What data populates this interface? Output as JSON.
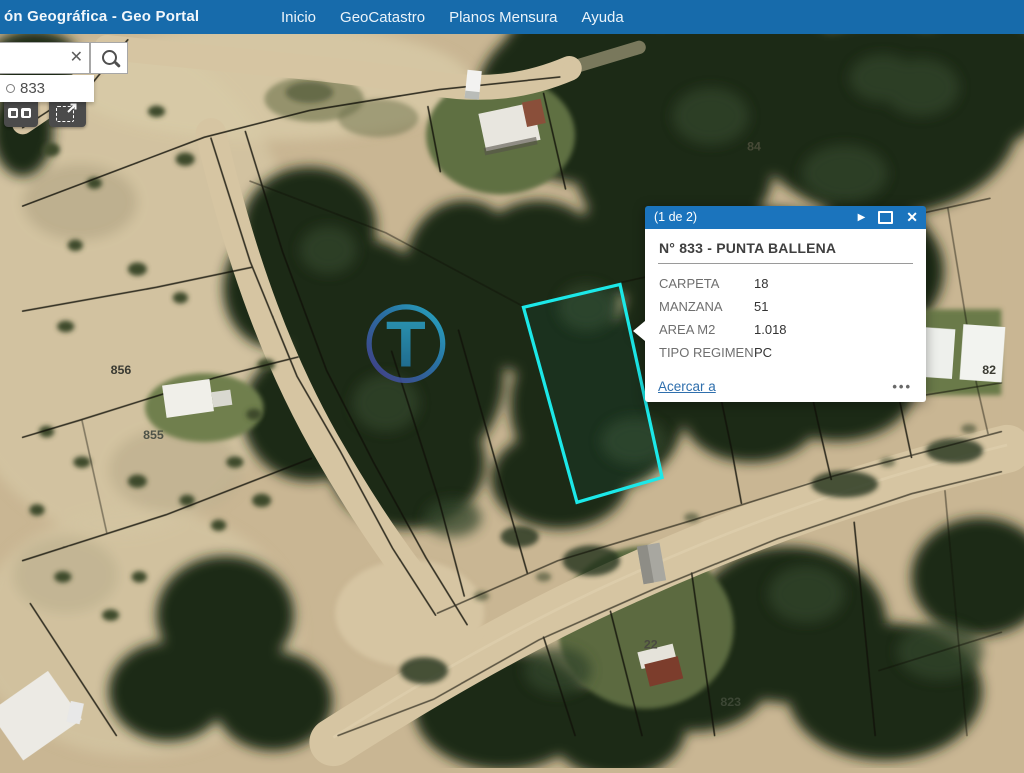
{
  "header": {
    "title": "ón Geográfica -  Geo Portal",
    "nav": [
      {
        "label": "Inicio"
      },
      {
        "label": "GeoCatastro"
      },
      {
        "label": "Planos Mensura"
      },
      {
        "label": "Ayuda"
      }
    ]
  },
  "search": {
    "input_value": "",
    "clear_icon": "✕",
    "suggestion_text": "833"
  },
  "popup": {
    "pagination": "(1 de 2)",
    "next_icon": "▶",
    "close_icon": "✕",
    "title": "N° 833 - PUNTA BALLENA",
    "fields": [
      {
        "label": "CARPETA",
        "value": "18"
      },
      {
        "label": "MANZANA",
        "value": "51"
      },
      {
        "label": "AREA M2",
        "value": "1.018"
      },
      {
        "label": "TIPO REGIMEN",
        "value": "PC"
      }
    ],
    "zoom_link": "Acercar a",
    "more_icon": "•••"
  },
  "map": {
    "parcel_labels": [
      {
        "text": "856"
      },
      {
        "text": "855"
      },
      {
        "text": "84"
      },
      {
        "text": "82"
      },
      {
        "text": "823"
      },
      {
        "text": "22"
      }
    ],
    "highlight_color": "#1ce8e8",
    "watermark_letter": "T"
  },
  "colors": {
    "header_blue": "#176bab",
    "popup_header_blue": "#1b74bd",
    "link_blue": "#2f6fad"
  }
}
